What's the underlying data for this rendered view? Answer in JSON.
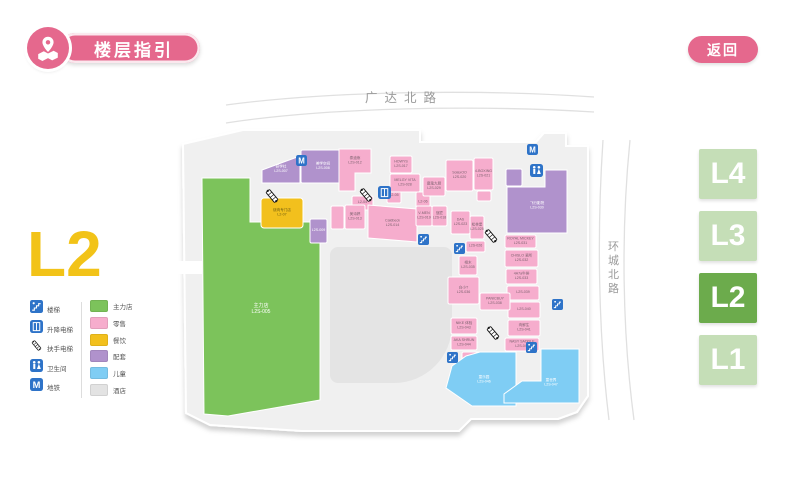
{
  "header": {
    "title": "楼层指引",
    "back_label": "返回"
  },
  "floor": {
    "current_label": "L2",
    "accent_color": "#f2c318"
  },
  "floor_buttons": [
    {
      "label": "L4",
      "active": false
    },
    {
      "label": "L3",
      "active": false
    },
    {
      "label": "L2",
      "active": true
    },
    {
      "label": "L1",
      "active": false
    }
  ],
  "colors": {
    "pink_accent": "#e5688d",
    "floor_active": "#6cab4c",
    "floor_inactive": "#c5deb7",
    "plate": "#f0f0f0",
    "atrium": "#e4e4e4",
    "icon_blue": "#2e73c8",
    "road_line": "#e0e0e0",
    "road_text": "#9a9a9a"
  },
  "legend": {
    "facilities": [
      {
        "icon": "stairs-icon",
        "label": "楼梯"
      },
      {
        "icon": "elevator-icon",
        "label": "升降电梯"
      },
      {
        "icon": "escalator-icon",
        "label": "扶手电梯"
      },
      {
        "icon": "restroom-icon",
        "label": "卫生间"
      },
      {
        "icon": "metro-icon",
        "label": "地铁"
      }
    ],
    "categories": [
      {
        "key": "anchor",
        "label": "主力店",
        "color": "#7cc35b"
      },
      {
        "key": "retail",
        "label": "零售",
        "color": "#f6adcd"
      },
      {
        "key": "dining",
        "label": "餐饮",
        "color": "#f2c01d"
      },
      {
        "key": "support",
        "label": "配套",
        "color": "#b092cc"
      },
      {
        "key": "kids",
        "label": "儿童",
        "color": "#7fcdf4"
      },
      {
        "key": "hotel",
        "label": "酒店",
        "color": "#e3e3e3"
      }
    ]
  },
  "map": {
    "roads": {
      "top_label": "广达北路",
      "right_label": "环城北路"
    },
    "blocks": [
      {
        "c": "anchor",
        "p": [
          202,
          178,
          250,
          178,
          250,
          222,
          320,
          222,
          320,
          400,
          228,
          416,
          204,
          414
        ],
        "t": [
          "主力店",
          "L2S-005"
        ],
        "ly": 310
      },
      {
        "c": "support",
        "p": [
          262,
          170,
          300,
          156,
          300,
          183,
          262,
          183
        ],
        "t": [
          "研学社",
          "L2S-007"
        ]
      },
      {
        "c": "support",
        "x": 301,
        "y": 150,
        "w": 44,
        "h": 33,
        "t": [
          "美学空间",
          "L2S-008"
        ]
      },
      {
        "c": "support",
        "x": 310,
        "y": 219,
        "w": 17,
        "h": 24,
        "t": [
          "L2S-009"
        ]
      },
      {
        "c": "retail",
        "p": [
          339,
          149,
          371,
          149,
          371,
          173,
          355,
          173,
          355,
          191,
          339,
          191
        ],
        "t": [
          "泰迪熊",
          "L2S-012"
        ],
        "ly": 161
      },
      {
        "c": "retail",
        "x": 352,
        "y": 196,
        "w": 21,
        "h": 14,
        "t": [
          "L2-04"
        ]
      },
      {
        "c": "retail",
        "x": 387,
        "y": 189,
        "w": 14,
        "h": 14,
        "t": [
          "L2-05"
        ]
      },
      {
        "c": "retail",
        "x": 416,
        "y": 192,
        "w": 14,
        "h": 21,
        "t": [
          "L2-06"
        ]
      },
      {
        "c": "dining",
        "x": 261,
        "y": 198,
        "w": 42,
        "h": 30,
        "t": [
          "烧肉专门店",
          "L2-07"
        ],
        "rx": 3
      },
      {
        "c": "retail",
        "x": 331,
        "y": 206,
        "w": 13,
        "h": 23,
        "t": []
      },
      {
        "c": "retail",
        "x": 345,
        "y": 205,
        "w": 20,
        "h": 24,
        "t": [
          "美诗婷",
          "L2S-013"
        ]
      },
      {
        "c": "retail",
        "p": [
          368,
          205,
          417,
          209,
          417,
          242,
          368,
          238
        ],
        "t": [
          "Caldbeck",
          "L2S-014"
        ]
      },
      {
        "c": "retail",
        "x": 416,
        "y": 206,
        "w": 16,
        "h": 20,
        "t": [
          "V-MEN",
          "L2S-019"
        ]
      },
      {
        "c": "retail",
        "x": 432,
        "y": 206,
        "w": 15,
        "h": 20,
        "t": [
          "寇匠",
          "L2S-018"
        ]
      },
      {
        "c": "retail",
        "x": 451,
        "y": 211,
        "w": 19,
        "h": 23,
        "t": [
          "DAS",
          "L2S-023"
        ]
      },
      {
        "c": "retail",
        "x": 470,
        "y": 216,
        "w": 14,
        "h": 23,
        "t": [
          "松林堡",
          "L2S-025"
        ]
      },
      {
        "c": "retail",
        "x": 466,
        "y": 241,
        "w": 19,
        "h": 11,
        "t": [
          "L2S-026"
        ]
      },
      {
        "c": "retail",
        "x": 390,
        "y": 156,
        "w": 22,
        "h": 17,
        "t": [
          "HOWYS",
          "L2S-017"
        ]
      },
      {
        "c": "retail",
        "x": 390,
        "y": 174,
        "w": 30,
        "h": 18,
        "t": [
          "MELGY VITA",
          "L2S-028"
        ]
      },
      {
        "c": "retail",
        "x": 423,
        "y": 177,
        "w": 22,
        "h": 19,
        "t": [
          "魔鬼大厨",
          "L2S-029"
        ]
      },
      {
        "c": "retail",
        "x": 446,
        "y": 160,
        "w": 27,
        "h": 31,
        "t": [
          "SolaxOO",
          "L2S-020"
        ]
      },
      {
        "c": "retail",
        "x": 474,
        "y": 158,
        "w": 19,
        "h": 32,
        "t": [
          "4-BOXING",
          "L2S-021"
        ]
      },
      {
        "c": "retail",
        "x": 477,
        "y": 191,
        "w": 14,
        "h": 10,
        "t": []
      },
      {
        "c": "support",
        "x": 506,
        "y": 169,
        "w": 16,
        "h": 17,
        "t": []
      },
      {
        "c": "support",
        "p": [
          507,
          187,
          545,
          187,
          545,
          170,
          567,
          170,
          567,
          233,
          507,
          233
        ],
        "t": [
          "飞行影院",
          "L2S-030"
        ],
        "ly": 206
      },
      {
        "c": "retail",
        "x": 505,
        "y": 235,
        "w": 31,
        "h": 13,
        "t": [
          "ROYAL MICKEY",
          "L2S-031"
        ]
      },
      {
        "c": "retail",
        "x": 505,
        "y": 250,
        "w": 33,
        "h": 17,
        "t": [
          "CHISLO 瓷所",
          "L2S-032"
        ]
      },
      {
        "c": "retail",
        "x": 506,
        "y": 269,
        "w": 31,
        "h": 15,
        "t": [
          "4A7a牛排",
          "L2S-033"
        ]
      },
      {
        "c": "retail",
        "x": 507,
        "y": 286,
        "w": 32,
        "h": 14,
        "t": [
          "L2S-039"
        ]
      },
      {
        "c": "retail",
        "x": 508,
        "y": 302,
        "w": 32,
        "h": 16,
        "t": [
          "L2S-040"
        ]
      },
      {
        "c": "retail",
        "x": 508,
        "y": 320,
        "w": 32,
        "h": 16,
        "t": [
          "肉鲜生",
          "L2S-041"
        ]
      },
      {
        "c": "retail",
        "x": 505,
        "y": 338,
        "w": 34,
        "h": 13,
        "t": [
          "NASY SADDLE",
          "L2S-042"
        ]
      },
      {
        "c": "retail",
        "x": 459,
        "y": 256,
        "w": 18,
        "h": 19,
        "t": [
          "相木",
          "L2S-035"
        ]
      },
      {
        "c": "retail",
        "x": 448,
        "y": 277,
        "w": 31,
        "h": 27,
        "t": [
          "白小T",
          "L2S-036"
        ]
      },
      {
        "c": "retail",
        "x": 480,
        "y": 293,
        "w": 30,
        "h": 17,
        "t": [
          "PANICBUY",
          "L2S-038"
        ]
      },
      {
        "c": "retail",
        "x": 451,
        "y": 318,
        "w": 26,
        "h": 16,
        "t": [
          "NIKE 体验",
          "L2S-043"
        ]
      },
      {
        "c": "retail",
        "x": 451,
        "y": 336,
        "w": 26,
        "h": 14,
        "t": [
          "AKA SHRUN",
          "L2S-044"
        ]
      },
      {
        "c": "retail",
        "x": 462,
        "y": 352,
        "w": 20,
        "h": 11,
        "t": []
      },
      {
        "c": "kids",
        "p": [
          452,
          366,
          466,
          356,
          480,
          352,
          516,
          352,
          516,
          406,
          472,
          406,
          446,
          388
        ],
        "t": [
          "童乐园",
          "L2S-046"
        ],
        "lx": 484,
        "ly": 380
      },
      {
        "c": "kids",
        "p": [
          541,
          349,
          579,
          349,
          579,
          403,
          504,
          403,
          504,
          394,
          522,
          381,
          541,
          381
        ],
        "t": [
          "童世界",
          "L2S-047"
        ],
        "lx": 551,
        "ly": 383
      }
    ],
    "icons": [
      {
        "type": "escalator-icon",
        "x": 272,
        "y": 196,
        "rot": -40
      },
      {
        "type": "escalator-icon",
        "x": 366,
        "y": 195,
        "rot": -40
      },
      {
        "type": "escalator-icon",
        "x": 491,
        "y": 236,
        "rot": -40
      },
      {
        "type": "escalator-icon",
        "x": 493,
        "y": 333,
        "rot": -40
      },
      {
        "type": "stairs-icon",
        "x": 418,
        "y": 234,
        "s": 11
      },
      {
        "type": "stairs-icon",
        "x": 454,
        "y": 243,
        "s": 11
      },
      {
        "type": "stairs-icon",
        "x": 552,
        "y": 299,
        "s": 11
      },
      {
        "type": "stairs-icon",
        "x": 526,
        "y": 342,
        "s": 11
      },
      {
        "type": "stairs-icon",
        "x": 447,
        "y": 352,
        "s": 11
      },
      {
        "type": "elevator-icon",
        "x": 378,
        "y": 186,
        "s": 13
      },
      {
        "type": "restroom-icon",
        "x": 530,
        "y": 164,
        "s": 13
      },
      {
        "type": "metro-icon",
        "x": 296,
        "y": 155,
        "s": 11
      },
      {
        "type": "metro-icon",
        "x": 527,
        "y": 144,
        "s": 11
      }
    ]
  }
}
